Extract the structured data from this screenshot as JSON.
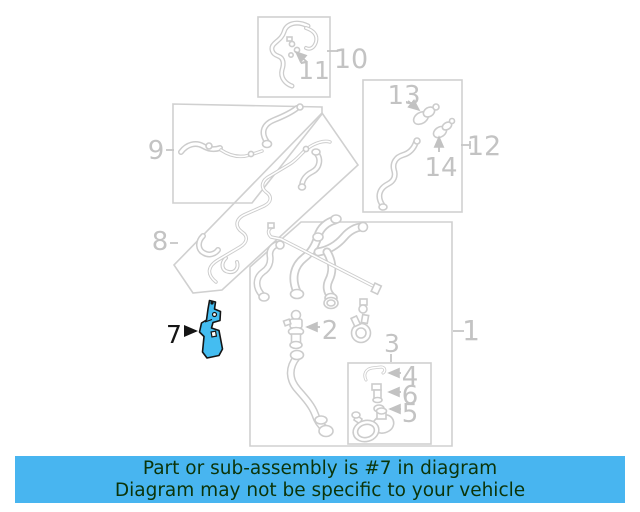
{
  "diagram": {
    "highlighted_part_label": "7",
    "callouts": {
      "1": "1",
      "2": "2",
      "3": "3",
      "4": "4",
      "5": "5",
      "6": "6",
      "7": "7",
      "8": "8",
      "9": "9",
      "10": "10",
      "11": "11",
      "12": "12",
      "13": "13",
      "14": "14"
    },
    "colors": {
      "line_gray": "#cccccc",
      "label_gray": "#c3c3c3",
      "highlight_fill": "#44bdf1",
      "highlight_outline": "#151515"
    }
  },
  "banner": {
    "line1": "Part or sub-assembly is #7 in diagram",
    "line2": "Diagram may not be specific to your vehicle",
    "bg": "#48b5f0",
    "text": "#0b3409"
  }
}
